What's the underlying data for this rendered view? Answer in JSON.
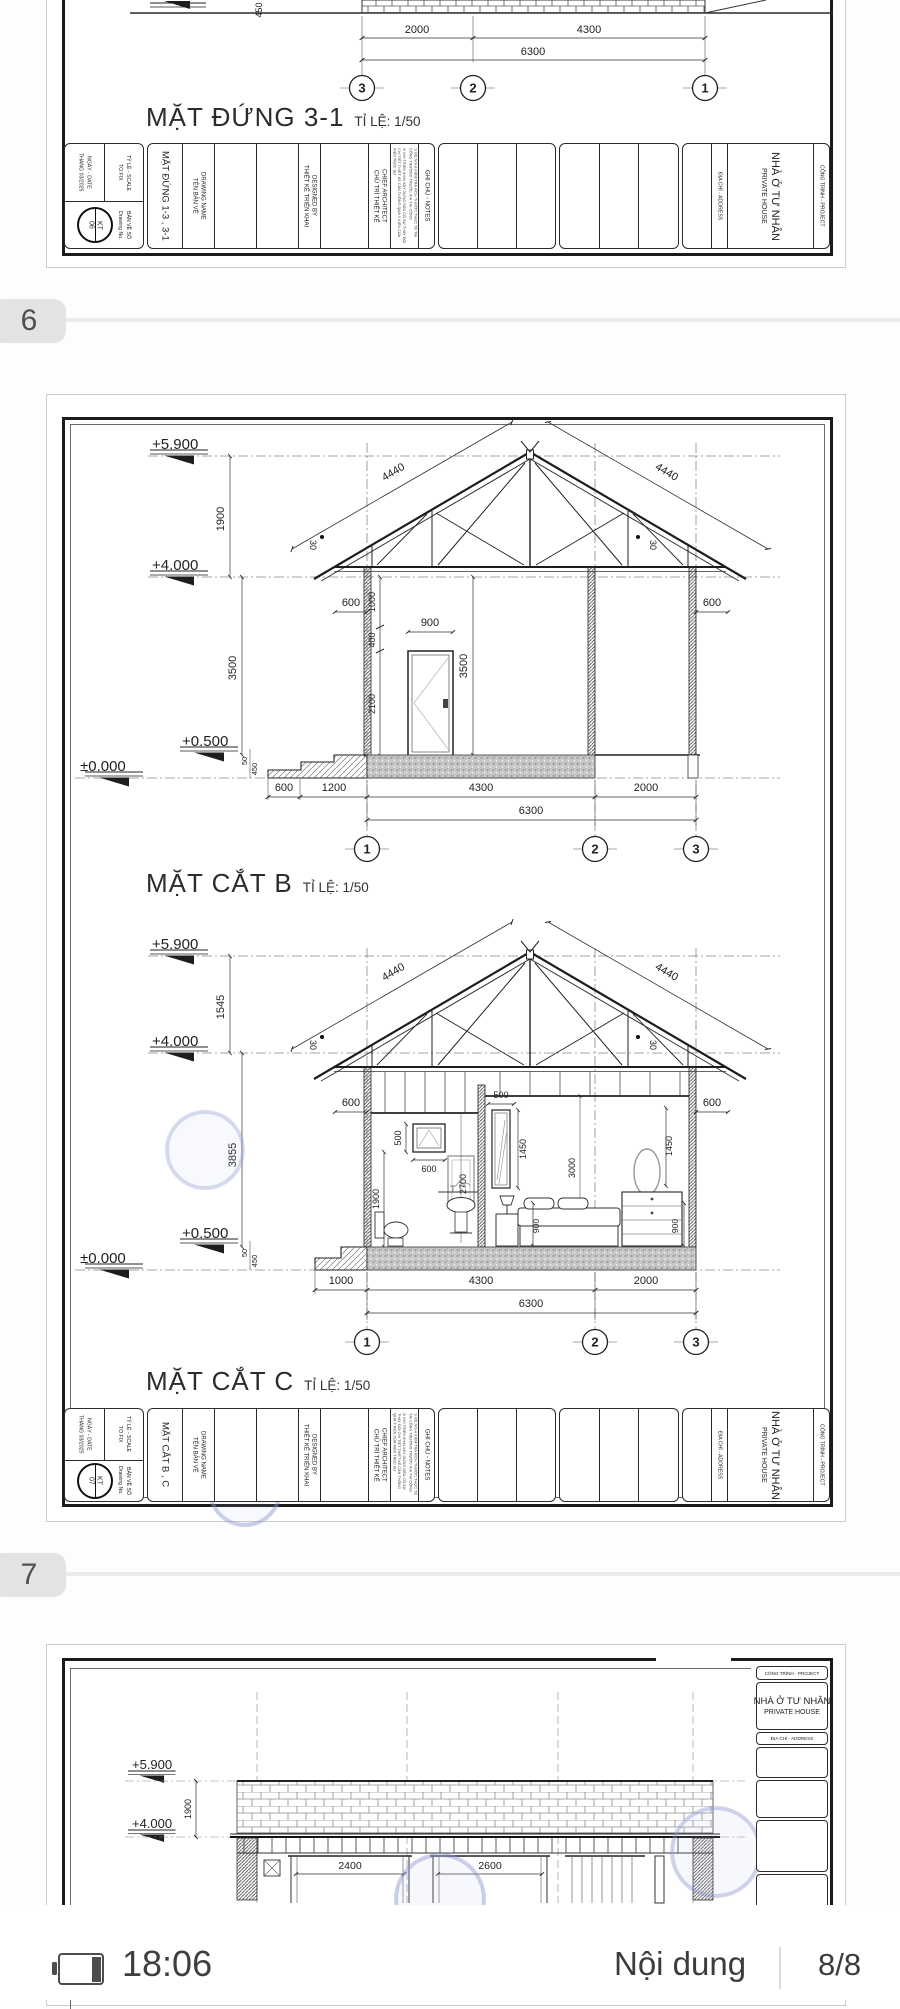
{
  "pages": {
    "p5": {
      "title": "MẶT ĐỨNG 3-1",
      "scale": "TỈ LỆ: 1/50",
      "sheet_no": "06",
      "drawing_name": "MẶT ĐỨNG 1-3 , 3-1"
    },
    "p6": {
      "title_b": "MẶT CẮT B",
      "title_c": "MẶT CẮT C",
      "scale": "TỈ LỆ: 1/50",
      "sheet_no": "07",
      "drawing_name": "MẶT CẮT B , C"
    },
    "p7": {
      "proj_vi": "NHÀ Ở TƯ NHÂN",
      "proj_en": "PRIVATE HOUSE",
      "proj_label": "CÔNG TRÌNH - PROJECT",
      "addr": "ĐỊA CHỈ - ADDRESS"
    }
  },
  "tb": {
    "scale_vi": "TỶ LỆ - SCALE",
    "scale_en": "TO FIX",
    "date_vi": "NGÀY - DATE",
    "date_en": "THÁNG 03/2025",
    "stamp": "KT",
    "no_vi": "BẢN VẼ SỐ",
    "no_en": "Drawing No.",
    "name_vi": "TÊN BẢN VẼ",
    "name_en": "DRAWING NAME",
    "designed_vi": "THIẾT KẾ TRIỂN KHAI",
    "designed_en": "DESIGNED BY",
    "chief_vi": "CHỦ TRÌ THIẾT KẾ",
    "chief_en": "CHIEF ARCHITECT",
    "notes": "GHI CHÚ - NOTES",
    "note1": "1/ ĐỀ NGHỊ KIỂM TRA KÍCH THƯỚC THỰC TẾ TẠI CÔNG TRƯỜNG TRƯỚC KHI THI CÔNG",
    "note2": "2/ KHI TRIỂN KHAI XÂY DỰNG NẾU CÓ SỰ THAY ĐỔI CHI TIẾT THIẾT KẾ CẦN THÔNG QUA Ý KIẾN CỦA KIẾN TRÚC SƯ",
    "addr": "ĐỊA CHỈ - ADDRESS",
    "proj_vi": "NHÀ Ở TƯ NHÂN",
    "proj_en": "PRIVATE HOUSE",
    "proj_label": "CÔNG TRÌNH - PROJECT"
  },
  "dims": {
    "lv59": "+5.900",
    "lv40": "+4.000",
    "lv05": "+0.500",
    "lv00": "±0.000",
    "d1900": "1900",
    "d1545": "1545",
    "d3500": "3500",
    "d3855": "3855",
    "d4440": "4440",
    "a30": "30",
    "d600": "600",
    "d900": "900",
    "d1000": "1000",
    "d400": "400",
    "d2100": "2100",
    "d1200": "1200",
    "d4300": "4300",
    "d2000": "2000",
    "d6300": "6300",
    "d50": "50",
    "d450": "450",
    "d500": "500",
    "d2700": "2700",
    "d1450": "1450",
    "d3000": "3000",
    "d2400": "2400",
    "d2600": "2600"
  },
  "grid": {
    "g1": "1",
    "g2": "2",
    "g3": "3"
  },
  "pager": {
    "p6": "6",
    "p7": "7"
  },
  "statusbar": {
    "time": "18:06",
    "contents_label": "Nội dung",
    "page_indicator": "8/8"
  },
  "colors": {
    "watermark": "#8d97cd",
    "tab_bg": "#e3e3e3",
    "separator": "#ececec",
    "text_dark": "#3f3f3f"
  }
}
